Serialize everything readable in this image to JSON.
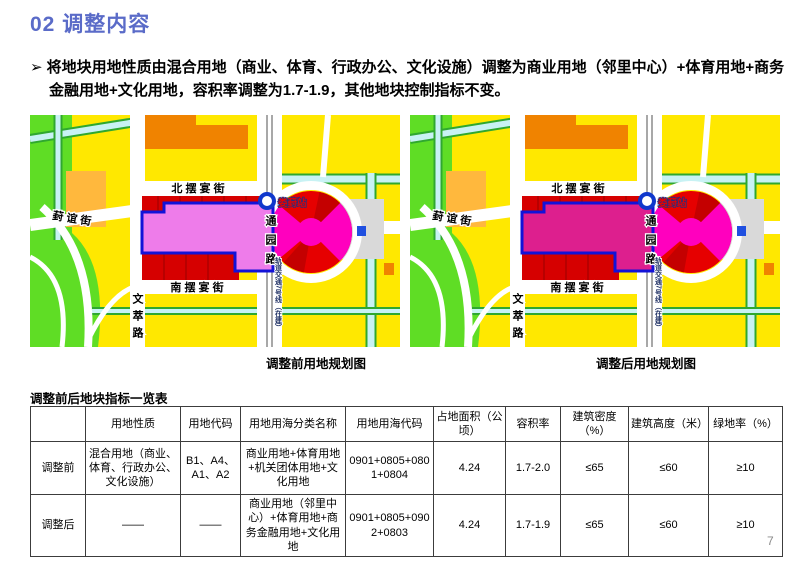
{
  "slide": {
    "title": "02 调整内容",
    "page_number": "7"
  },
  "bullet": {
    "marker": "➢",
    "text": "将地块用地性质由混合用地（商业、体育、行政办公、文化设施）调整为商业用地（邻里中心）+体育用地+商务金融用地+文化用地，容积率调整为1.7-1.9，其他地块控制指标不变。"
  },
  "maps": {
    "street_labels": {
      "north_street": "北 摆 宴 街",
      "south_street": "南 摆 宴 街",
      "fengyi_street": "葑 谊 街",
      "wencui_road": "文萃路",
      "tongyuan_road": "通园路",
      "station": "娄葑站",
      "metro_line": "轨道交通7号线（在建）"
    },
    "before": {
      "caption": "调整前用地规划图",
      "plot_color": "#ee7cea"
    },
    "after": {
      "caption": "调整后用地规划图",
      "plot_color": "#dd1f8e"
    },
    "palette": {
      "residential_yellow": "#ffe800",
      "green_space": "#5fdd25",
      "water": "#c8f2f4",
      "commercial_red": "#d60000",
      "plaza_magenta": "#ff00be",
      "orange_block": "#f08300",
      "light_orange_block": "#ffb83d",
      "gray_block": "#d9d9d9",
      "plot_outline_blue": "#1212d8"
    }
  },
  "table": {
    "title": "调整前后地块指标一览表",
    "headers": [
      "",
      "用地性质",
      "用地代码",
      "用地用海分类名称",
      "用地用海代码",
      "占地面积（公顷）",
      "容积率",
      "建筑密度（%）",
      "建筑高度（米）",
      "绿地率（%）"
    ],
    "rows": [
      {
        "label": "调整前",
        "cells": [
          "混合用地（商业、体育、行政办公、文化设施）",
          "B1、A4、A1、A2",
          "商业用地+体育用地+机关团体用地+文化用地",
          "0901+0805+0801+0804",
          "4.24",
          "1.7-2.0",
          "≤65",
          "≤60",
          "≥10"
        ]
      },
      {
        "label": "调整后",
        "cells": [
          "——",
          "——",
          "商业用地（邻里中心）+体育用地+商务金融用地+文化用地",
          "0901+0805+0902+0803",
          "4.24",
          "1.7-1.9",
          "≤65",
          "≤60",
          "≥10"
        ]
      }
    ]
  }
}
